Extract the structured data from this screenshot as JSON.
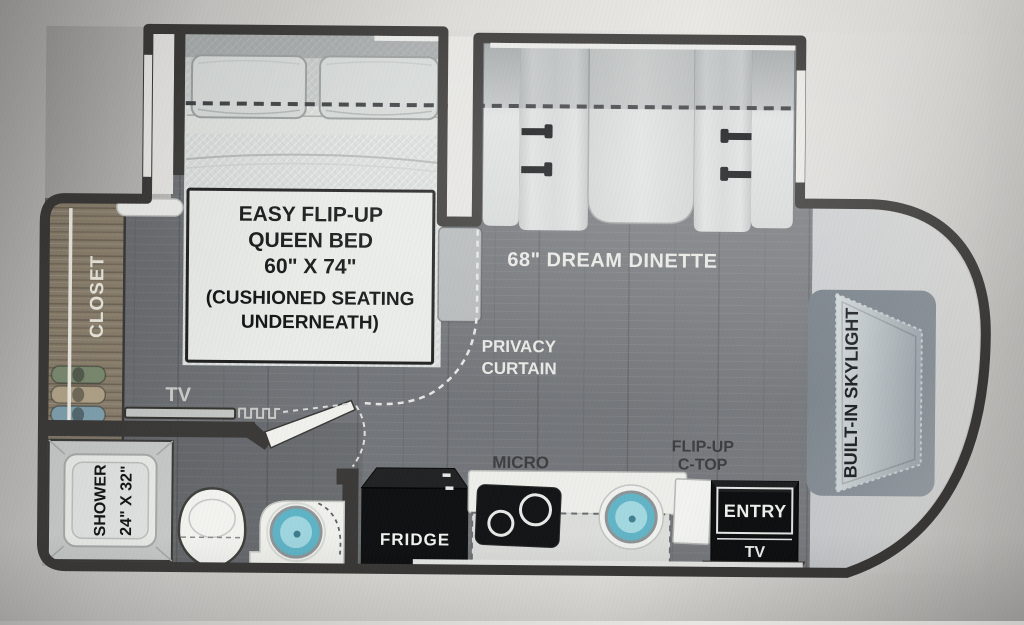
{
  "floorplan": {
    "bed": {
      "line1": "EASY FLIP-UP",
      "line2": "QUEEN BED",
      "line3": "60\" X 74\"",
      "line4": "(CUSHIONED SEATING",
      "line5": "UNDERNEATH)"
    },
    "dinette_label": "68\" DREAM DINETTE",
    "privacy_curtain": {
      "line1": "PRIVACY",
      "line2": "CURTAIN"
    },
    "closet_label": "CLOSET",
    "bedroom_tv_label": "TV",
    "shower": {
      "line1": "SHOWER",
      "line2": "24\" X 32\""
    },
    "micro_label": "MICRO",
    "fridge_label": "FRIDGE",
    "flip_up_ctop": {
      "line1": "FLIP-UP",
      "line2": "C-TOP"
    },
    "entry_label": "ENTRY",
    "entry_tv_label": "TV",
    "skylight_label": "BUILT-IN SKYLIGHT",
    "colors": {
      "wall": "#3b3a38",
      "floor": "#73767a",
      "closet_wood": "#8a7f6e",
      "sink_teal": "#62b4c6",
      "cushion": "#d3d7d6",
      "cab_area": "#d2d3d1"
    }
  }
}
